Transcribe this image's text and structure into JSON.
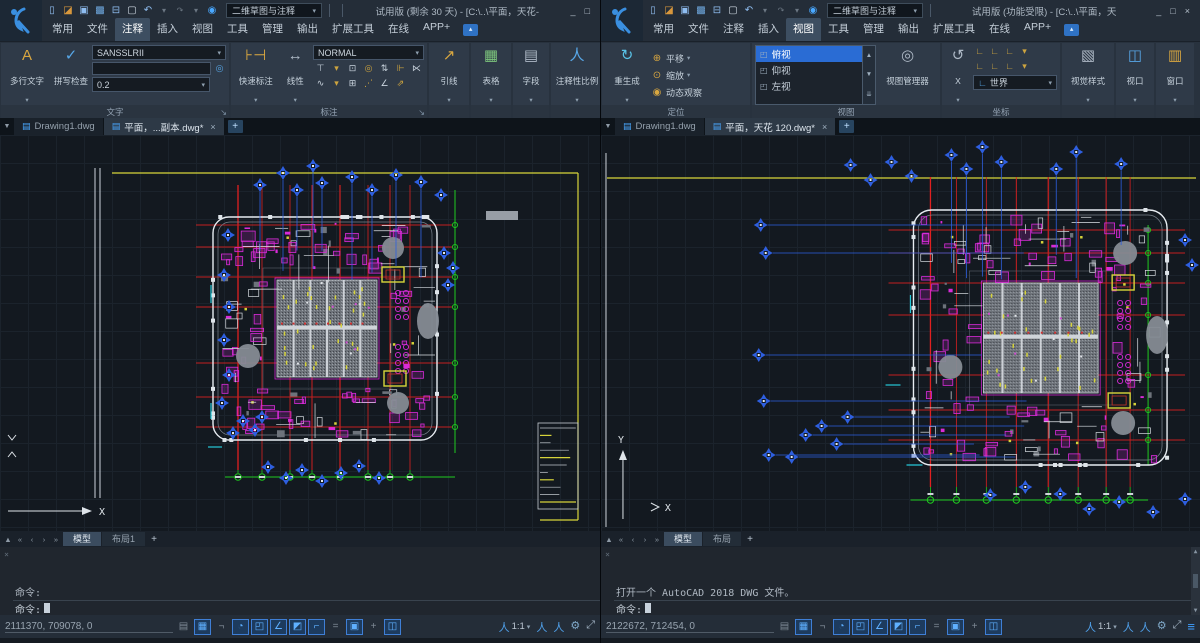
{
  "windows": [
    {
      "titlebar": {
        "workspace": "二维草图与注释",
        "title": "试用版 (剩余 30 天) - [C:\\..\\平面，天花-",
        "window_buttons": [
          {
            "name": "minimize-button",
            "glyph": "_"
          },
          {
            "name": "maximize-button",
            "glyph": "□"
          }
        ]
      },
      "quick_access": [
        {
          "name": "new-icon",
          "glyph": "▯"
        },
        {
          "name": "open-icon",
          "glyph": "◪"
        },
        {
          "name": "save-icon",
          "glyph": "▣"
        },
        {
          "name": "save-as-icon",
          "glyph": "▩"
        },
        {
          "name": "print-icon",
          "glyph": "⊟"
        },
        {
          "name": "select-icon",
          "glyph": "▢"
        },
        {
          "name": "undo-icon",
          "glyph": "↶"
        },
        {
          "name": "caret-icon",
          "glyph": "▾"
        },
        {
          "name": "redo-icon",
          "glyph": "↷"
        },
        {
          "name": "caret-icon",
          "glyph": "▾"
        },
        {
          "name": "help-icon",
          "glyph": "◉"
        }
      ],
      "ribbon_tabs": [
        {
          "label": "常用"
        },
        {
          "label": "文件"
        },
        {
          "label": "注释",
          "active": true
        },
        {
          "label": "插入"
        },
        {
          "label": "视图"
        },
        {
          "label": "工具"
        },
        {
          "label": "管理"
        },
        {
          "label": "输出"
        },
        {
          "label": "扩展工具"
        },
        {
          "label": "在线"
        },
        {
          "label": "APP+"
        }
      ],
      "ribbon": {
        "text_panel": {
          "footer": "文字",
          "launcher_glyph": "↘",
          "mtext_button": {
            "label": "多行文字",
            "icon_glyph": "A"
          },
          "spell_button": {
            "label": "拼写检查",
            "icon_glyph": "✓"
          },
          "style_combo": "SANSSLRII",
          "find_icon_glyph": "◎",
          "height_combo": "0.2"
        },
        "dim_panel": {
          "footer": "标注",
          "launcher_glyph": "↘",
          "quick_button": {
            "label": "快速标注",
            "icon_glyph": "⊦⊣"
          },
          "linear_button": {
            "label": "线性",
            "icon_glyph": "↔"
          },
          "style_combo": "NORMAL",
          "tools_row1": [
            {
              "name": "baseline-dim-icon",
              "glyph": "⊤"
            },
            {
              "name": "caret-icon",
              "glyph": "▾"
            },
            {
              "name": "quick-dim-icon",
              "glyph": "⊡"
            },
            {
              "name": "center-mark-icon",
              "glyph": "◎"
            },
            {
              "name": "adjust-space-icon",
              "glyph": "⇅"
            },
            {
              "name": "break-dim-icon",
              "glyph": "⊩"
            },
            {
              "name": "inspect-dim-icon",
              "glyph": "⋉"
            }
          ],
          "tools_row2": [
            {
              "name": "jog-line-icon",
              "glyph": "∿"
            },
            {
              "name": "caret-icon",
              "glyph": "▾"
            },
            {
              "name": "tolerance-icon",
              "glyph": "⊞"
            },
            {
              "name": "oblique-icon",
              "glyph": "⋰"
            },
            {
              "name": "angle-dim-icon",
              "glyph": "∠"
            },
            {
              "name": "override-icon",
              "glyph": "⇗"
            }
          ]
        },
        "leader_button": {
          "label": "引线",
          "icon_glyph": "↗"
        },
        "table_button": {
          "label": "表格",
          "icon_glyph": "▦"
        },
        "field_button": {
          "label": "字段",
          "icon_glyph": "▤"
        },
        "annoscale_button": {
          "label": "注释性比例",
          "icon_glyph": "人"
        }
      },
      "doc_tabs": [
        {
          "label": "Drawing1.dwg",
          "closable": false
        },
        {
          "label": "平面，...副本.dwg*",
          "active": true,
          "closable": true
        }
      ],
      "layout_nav": [
        {
          "name": "layout-collapse-icon",
          "glyph": "▲"
        },
        {
          "name": "first-layout-icon",
          "glyph": "«"
        },
        {
          "name": "prev-layout-icon",
          "glyph": "‹"
        },
        {
          "name": "next-layout-icon",
          "glyph": "›"
        },
        {
          "name": "last-layout-icon",
          "glyph": "»"
        }
      ],
      "layout_tabs": [
        {
          "label": "模型",
          "active": true
        },
        {
          "label": "布局1"
        }
      ],
      "layout_plus": "+",
      "command": {
        "close_glyph": "×",
        "history": [
          "命令:",
          "命令:",
          "命令:",
          "命令: C:\\Users\\Gstar\\AppData\\Local\\Temp\\平面，天花 120   副本_zws06715.zs$"
        ],
        "prompt": "命令:"
      },
      "status": {
        "coords": "2111370, 709078, 0",
        "toggles": [
          {
            "name": "model-paper-toggle",
            "glyph": "▤",
            "active": false
          },
          {
            "name": "grid-toggle",
            "glyph": "▦",
            "active": true
          },
          {
            "name": "ortho-toggle",
            "glyph": "¬",
            "active": false
          },
          {
            "name": "polar-toggle",
            "glyph": "◔",
            "active": true
          },
          {
            "name": "osnap-toggle",
            "glyph": "◰",
            "active": true
          },
          {
            "name": "angle-snap-toggle",
            "glyph": "∠",
            "active": true
          },
          {
            "name": "otrack-toggle",
            "glyph": "◩",
            "active": true
          },
          {
            "name": "ducs-toggle",
            "glyph": "⌐",
            "active": true
          },
          {
            "name": "lineweight-toggle",
            "glyph": "=",
            "active": false
          },
          {
            "name": "dyninput-toggle",
            "glyph": "▣",
            "active": true
          },
          {
            "name": "anno-add-toggle",
            "glyph": "+",
            "active": false
          },
          {
            "name": "quickprop-toggle",
            "glyph": "◫",
            "active": true
          }
        ],
        "scale": {
          "icon_glyph": "人",
          "value": "1:1",
          "caret": "▾"
        },
        "right_icons": [
          {
            "name": "annotation-visibility-icon",
            "glyph": "人"
          },
          {
            "name": "annotation-autoscale-icon",
            "glyph": "人"
          },
          {
            "name": "workspace-gear-icon",
            "glyph": "⚙"
          },
          {
            "name": "fullscreen-icon",
            "glyph": "⤢"
          }
        ]
      }
    },
    {
      "titlebar": {
        "workspace": "二维草图与注释",
        "title": "试用版 (功能受限) - [C:\\..\\平面，天",
        "window_buttons": [
          {
            "name": "minimize-button",
            "glyph": "_"
          },
          {
            "name": "maximize-button",
            "glyph": "□"
          },
          {
            "name": "close-button",
            "glyph": "×"
          }
        ]
      },
      "quick_access": [
        {
          "name": "new-icon",
          "glyph": "▯"
        },
        {
          "name": "open-icon",
          "glyph": "◪"
        },
        {
          "name": "save-icon",
          "glyph": "▣"
        },
        {
          "name": "save-as-icon",
          "glyph": "▩"
        },
        {
          "name": "print-icon",
          "glyph": "⊟"
        },
        {
          "name": "select-icon",
          "glyph": "▢"
        },
        {
          "name": "undo-icon",
          "glyph": "↶"
        },
        {
          "name": "caret-icon",
          "glyph": "▾"
        },
        {
          "name": "redo-icon",
          "glyph": "↷"
        },
        {
          "name": "caret-icon",
          "glyph": "▾"
        },
        {
          "name": "help-icon",
          "glyph": "◉"
        }
      ],
      "ribbon_tabs": [
        {
          "label": "常用"
        },
        {
          "label": "文件"
        },
        {
          "label": "注释"
        },
        {
          "label": "插入"
        },
        {
          "label": "视图",
          "active": true
        },
        {
          "label": "工具"
        },
        {
          "label": "管理"
        },
        {
          "label": "输出"
        },
        {
          "label": "扩展工具"
        },
        {
          "label": "在线"
        },
        {
          "label": "APP+"
        }
      ],
      "ribbon": {
        "nav_panel": {
          "footer": "定位",
          "regen_button": {
            "label": "重生成",
            "icon_glyph": "↻"
          },
          "rows": [
            {
              "name": "pan-button",
              "label": "平移",
              "icon_glyph": "⊕",
              "caret": "▾"
            },
            {
              "name": "zoom-button",
              "label": "缩放",
              "icon_glyph": "⊙",
              "caret": "▾"
            },
            {
              "name": "orbit-button",
              "label": "动态观察",
              "icon_glyph": "◉",
              "caret": ""
            }
          ]
        },
        "view_panel": {
          "footer": "视图",
          "view_list": [
            {
              "label": "俯视",
              "active": true
            },
            {
              "label": "仰视"
            },
            {
              "label": "左视"
            }
          ],
          "scroll_icons": [
            {
              "name": "scroll-up-icon",
              "glyph": "▲"
            },
            {
              "name": "scroll-down-icon",
              "glyph": "▼"
            },
            {
              "name": "scroll-end-icon",
              "glyph": "⇊"
            }
          ],
          "manager_button": {
            "label": "视图管理器",
            "icon_glyph": "◎"
          }
        },
        "ucs_panel": {
          "footer": "坐标",
          "x_button": {
            "label": "X",
            "icon_glyph": "↺"
          },
          "tools_row1": [
            {
              "name": "ucs-icon",
              "glyph": "∟"
            },
            {
              "name": "ucs-origin-icon",
              "glyph": "∟"
            },
            {
              "name": "ucs-z-icon",
              "glyph": "∟"
            },
            {
              "name": "caret-icon",
              "glyph": "▾"
            }
          ],
          "tools_row2": [
            {
              "name": "ucs-view-icon",
              "glyph": "∟"
            },
            {
              "name": "ucs-object-icon",
              "glyph": "∟"
            },
            {
              "name": "ucs-face-icon",
              "glyph": "∟"
            },
            {
              "name": "caret-icon",
              "glyph": "▾"
            }
          ],
          "world_combo": {
            "value": "世界",
            "icon_glyph": "∟"
          }
        },
        "visualstyle_button": {
          "label": "视觉样式",
          "icon_glyph": "▧"
        },
        "viewport_button": {
          "label": "视口",
          "icon_glyph": "◫"
        },
        "window_button": {
          "label": "窗口",
          "icon_glyph": "▥"
        }
      },
      "doc_tabs": [
        {
          "label": "Drawing1.dwg",
          "closable": false
        },
        {
          "label": "平面，天花 120.dwg*",
          "active": true,
          "closable": true
        }
      ],
      "layout_nav": [
        {
          "name": "layout-collapse-icon",
          "glyph": "▲"
        },
        {
          "name": "first-layout-icon",
          "glyph": "«"
        },
        {
          "name": "prev-layout-icon",
          "glyph": "‹"
        },
        {
          "name": "next-layout-icon",
          "glyph": "›"
        },
        {
          "name": "last-layout-icon",
          "glyph": "»"
        }
      ],
      "layout_tabs": [
        {
          "label": "模型",
          "active": true
        },
        {
          "label": "布局"
        }
      ],
      "layout_plus": "+",
      "command": {
        "close_glyph": "×",
        "history": [
          "打开一个 AutoCAD 2018 DWG 文件。",
          "命令:",
          "命令:",
          "命令:"
        ],
        "prompt": "命令:"
      },
      "status": {
        "coords": "2122672, 712454, 0",
        "toggles": [
          {
            "name": "model-paper-toggle",
            "glyph": "▤",
            "active": false
          },
          {
            "name": "grid-toggle",
            "glyph": "▦",
            "active": true
          },
          {
            "name": "ortho-toggle",
            "glyph": "¬",
            "active": false
          },
          {
            "name": "polar-toggle",
            "glyph": "◔",
            "active": true
          },
          {
            "name": "osnap-toggle",
            "glyph": "◰",
            "active": true
          },
          {
            "name": "angle-snap-toggle",
            "glyph": "∠",
            "active": true
          },
          {
            "name": "otrack-toggle",
            "glyph": "◩",
            "active": true
          },
          {
            "name": "ducs-toggle",
            "glyph": "⌐",
            "active": true
          },
          {
            "name": "lineweight-toggle",
            "glyph": "=",
            "active": false
          },
          {
            "name": "dyninput-toggle",
            "glyph": "▣",
            "active": true
          },
          {
            "name": "anno-add-toggle",
            "glyph": "+",
            "active": false
          },
          {
            "name": "quickprop-toggle",
            "glyph": "◫",
            "active": true
          }
        ],
        "scale": {
          "icon_glyph": "人",
          "value": "1:1",
          "caret": "▾"
        },
        "right_icons": [
          {
            "name": "annotation-visibility-icon",
            "glyph": "人"
          },
          {
            "name": "annotation-autoscale-icon",
            "glyph": "人"
          },
          {
            "name": "workspace-gear-icon",
            "glyph": "⚙"
          },
          {
            "name": "fullscreen-icon",
            "glyph": "⤢"
          },
          {
            "name": "statusbar-menu-icon",
            "glyph": "≡"
          }
        ]
      }
    }
  ]
}
